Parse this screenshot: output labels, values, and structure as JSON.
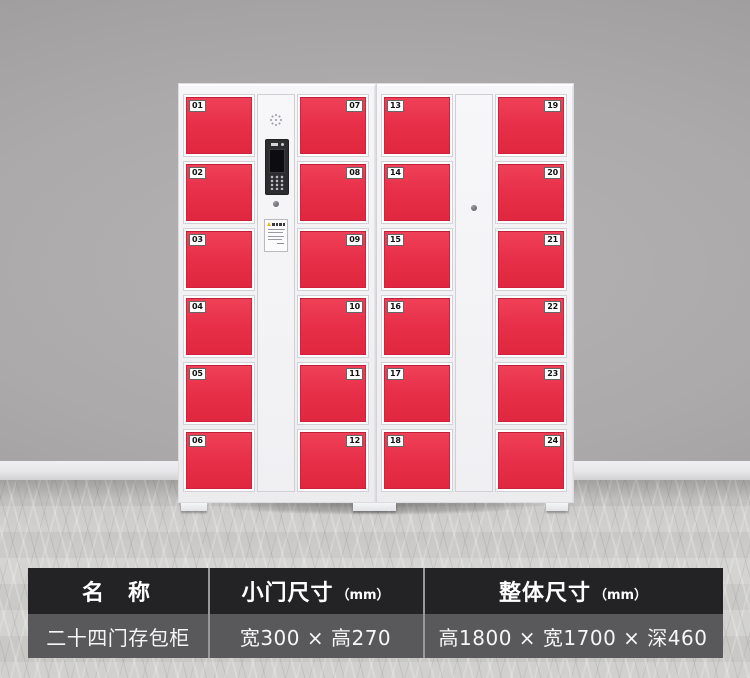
{
  "product_photo": {
    "door_color": "#e8304a",
    "door_color_hi": "#ef4158",
    "door_color_lo": "#e0273f",
    "cabinets": [
      {
        "left_doors": [
          "01",
          "02",
          "03",
          "04",
          "05",
          "06"
        ],
        "right_doors": [
          "07",
          "08",
          "09",
          "10",
          "11",
          "12"
        ],
        "center": "control-panel"
      },
      {
        "left_doors": [
          "13",
          "14",
          "15",
          "16",
          "17",
          "18"
        ],
        "right_doors": [
          "19",
          "20",
          "21",
          "22",
          "23",
          "24"
        ],
        "center": "plain-master-door"
      }
    ]
  },
  "spec_table": {
    "header_bg": "#232326",
    "row_bg": "#59595b",
    "divider_color": "#98989a",
    "columns": [
      {
        "header": "名　称",
        "unit": ""
      },
      {
        "header": "小门尺寸",
        "unit": "（mm）"
      },
      {
        "header": "整体尺寸",
        "unit": "（mm）"
      }
    ],
    "values": [
      "二十四门存包柜",
      "宽300 × 高270",
      "高1800 × 宽1700 × 深460"
    ]
  }
}
